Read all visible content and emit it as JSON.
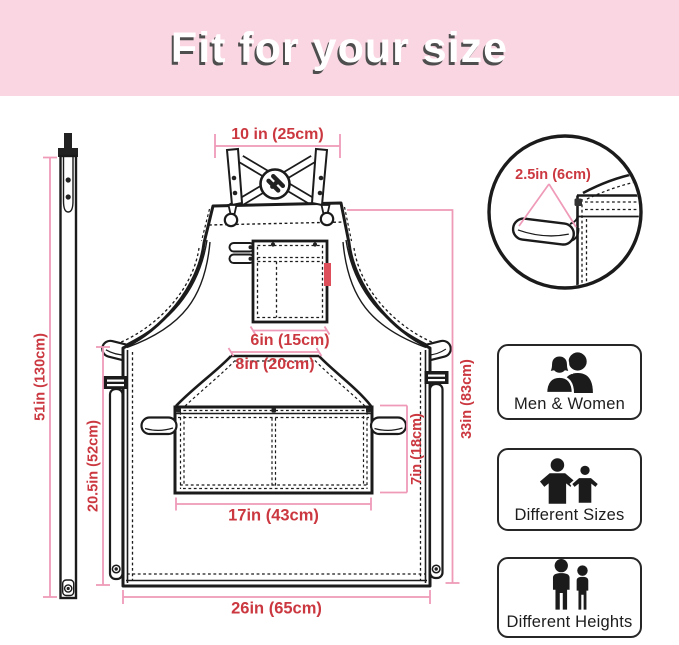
{
  "header": {
    "title": "Fit for your size"
  },
  "apron": {
    "dim_top_width": "10 in (25cm)",
    "dim_chest_pocket_width": "6in (15cm)",
    "dim_waist_pocket_top": "8in (20cm)",
    "dim_waist_pocket_width": "17in (43cm)",
    "dim_waist_pocket_height": "7in (18cm)",
    "dim_bottom_width": "26in (65cm)",
    "dim_side_height": "20.5in (52cm)",
    "dim_total_height": "33in (83cm)",
    "dim_strap_length": "51in (130cm)",
    "dim_loop_size": "2.5in (6cm)"
  },
  "features": [
    {
      "label": "Men & Women",
      "icon": "men-women-icon"
    },
    {
      "label": "Different Sizes",
      "icon": "different-sizes-icon"
    },
    {
      "label": "Different Heights",
      "icon": "different-heights-icon"
    }
  ],
  "colors": {
    "banner_bg": "#f9d6e1",
    "title_text": "#ffffff",
    "title_shadow": "#4e4e4e",
    "line_art": "#1b1b1b",
    "dimension_line": "#ef9ab8",
    "dimension_text": "#cb3840",
    "pocket_tag": "#dd4f5a"
  }
}
